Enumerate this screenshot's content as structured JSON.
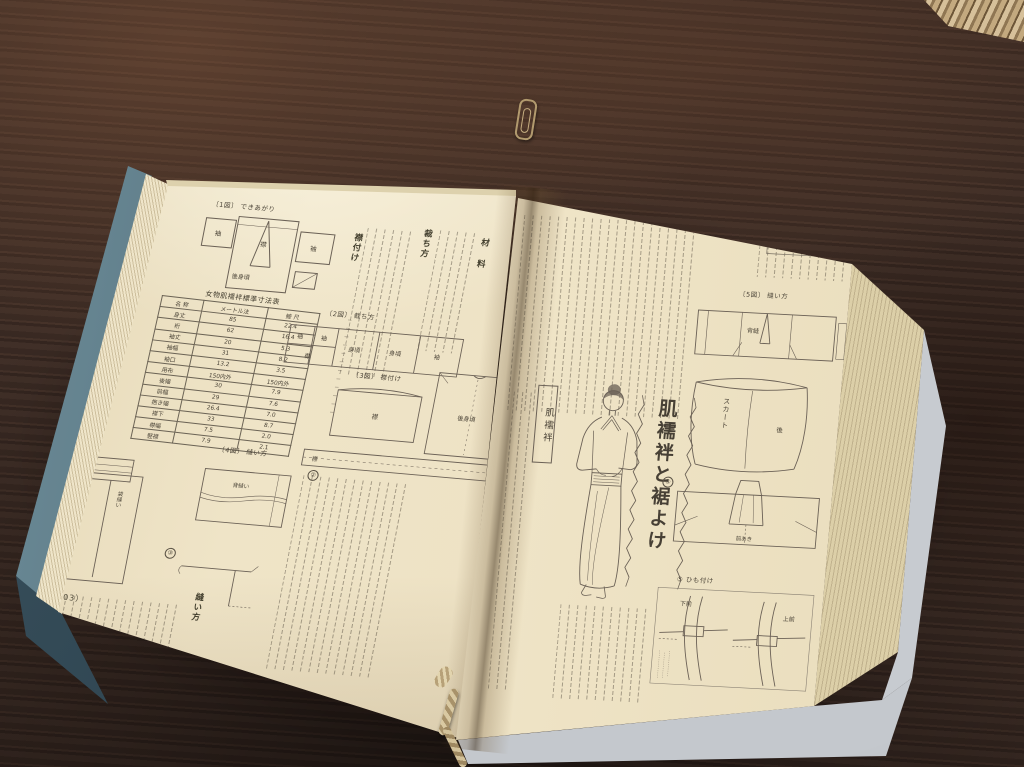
{
  "scene": {
    "setting": "open Japanese dressmaking book lying on a dark wooden table",
    "objects": {
      "paperclip": "gold paperclip",
      "basket": "wicker basket edge",
      "cord": "bookmark cord"
    },
    "colors": {
      "wood": "#3f2f28",
      "page": "#ece0c2",
      "cover_left": "#5f7f8c",
      "cover_right": "#c7cbd0",
      "basket": "#c9b289",
      "cord": "#cdb891",
      "ink": "#4a4337",
      "line": "#6b6156"
    }
  },
  "left_page": {
    "page_number": "（103）",
    "headings": {
      "materials": "材 料",
      "cutting": "裁ち方",
      "collar_attach": "襟付け",
      "sewing": "縫い方"
    },
    "fig1": {
      "caption": "〔1図〕 できあがり",
      "sleeve_l": "袖",
      "collar": "襟",
      "body": "後身頃",
      "sleeve_r": "袖"
    },
    "table": {
      "title": "女物肌襦袢標準寸法表",
      "columns": [
        "名 称",
        "メートル法",
        "鯨 尺"
      ],
      "rows": [
        [
          "身丈",
          "85",
          "22.4"
        ],
        [
          "裄",
          "62",
          "16.4"
        ],
        [
          "袖丈",
          "20",
          "5.3"
        ],
        [
          "袖幅",
          "31",
          "8.2"
        ],
        [
          "袖口",
          "13.2",
          "3.5"
        ],
        [
          "用布",
          "150内外",
          "150内外"
        ],
        [
          "後幅",
          "30",
          "7.9"
        ],
        [
          "前幅",
          "29",
          "7.6"
        ],
        [
          "抱き幅",
          "26.4",
          "7.0"
        ],
        [
          "襟下",
          "33",
          "8.7"
        ],
        [
          "襟幅",
          "7.5",
          "2.0"
        ],
        [
          "竪襟",
          "7.9",
          "2.1"
        ]
      ]
    },
    "fig2": {
      "caption": "〔2図〕 裁ち方",
      "pieces": [
        "袖",
        "袖",
        "襟",
        "身頃",
        "身頃",
        "袖"
      ]
    },
    "fig3": {
      "caption": "〔3図〕 襟付け",
      "collar": "襟",
      "body": "後身頃"
    },
    "collar_strip": {
      "label": "襟"
    },
    "fig4": {
      "caption": "〔4図〕 縫い方",
      "marks": [
        "①",
        "②",
        "③"
      ],
      "bag_seam": "袋縫い",
      "back_seam": "背縫い"
    }
  },
  "right_page": {
    "page_number": "（102）",
    "tag_label": "肌襦袢",
    "chapter_title": "肌襦袢と裾よけ",
    "fig5": {
      "caption": "〔5図〕 縫い方",
      "back_seam": "背縫"
    },
    "skirt": {
      "label": "スカート",
      "back": "後"
    },
    "collar_fig": {
      "mark": "④",
      "opening": "前あき"
    },
    "himo": {
      "caption": "⑤ ひも付け",
      "lower_front": "下前",
      "upper_front": "上前"
    }
  }
}
